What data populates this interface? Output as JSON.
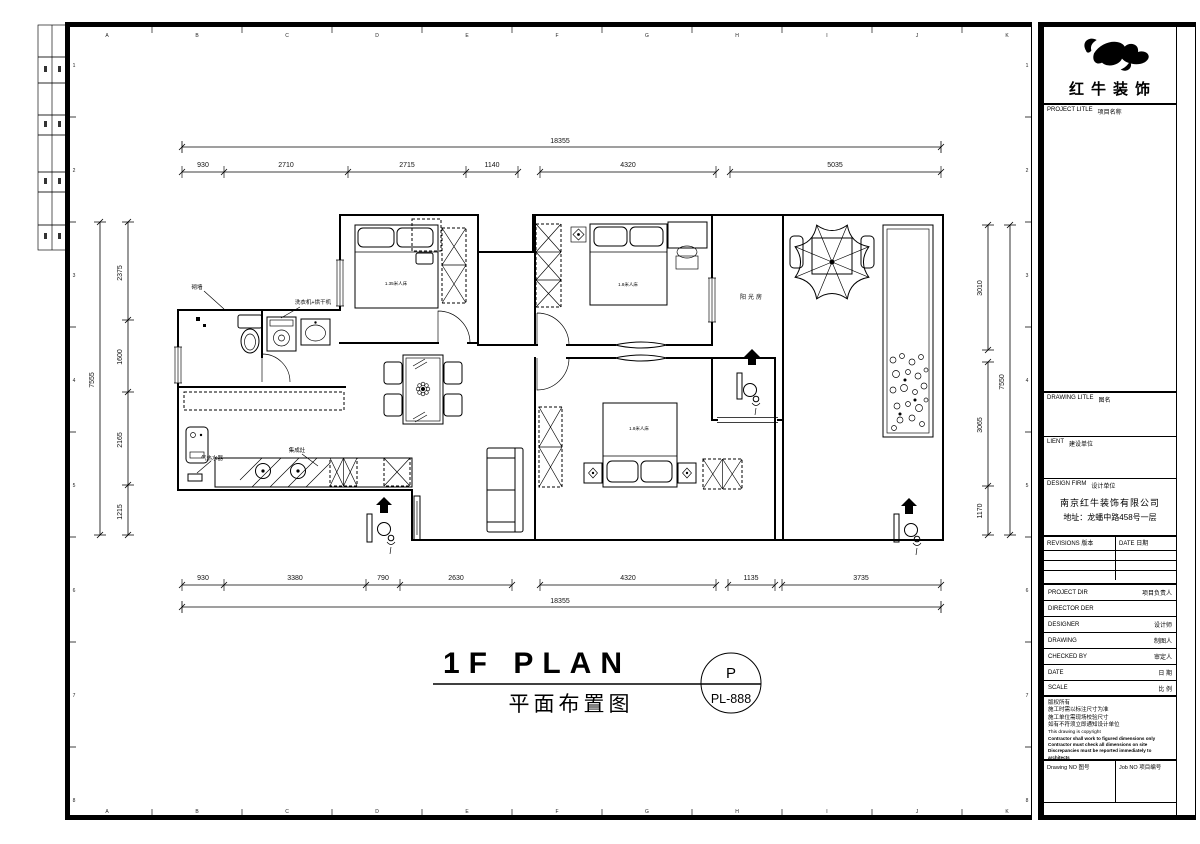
{
  "frame": {
    "letters": [
      "A",
      "B",
      "C",
      "D",
      "E",
      "F",
      "G",
      "H",
      "I",
      "J",
      "K"
    ],
    "numbers": [
      "1",
      "2",
      "3",
      "4",
      "5",
      "6",
      "7",
      "8"
    ]
  },
  "plan": {
    "dims": {
      "top_total": "18355",
      "top": [
        "930",
        "2710",
        "2715",
        "1140",
        "4320",
        "5035"
      ],
      "bottom": [
        "930",
        "3380",
        "790",
        "2630",
        "4320",
        "1135",
        "3735"
      ],
      "bottom_total": "18355",
      "left": [
        "2375",
        "1600",
        "2165",
        "1215"
      ],
      "left_total": "7555",
      "right": [
        "3010",
        "3065",
        "1170"
      ],
      "right_total": "7550"
    },
    "labels": {
      "build_wall": "砌墙",
      "washer_dryer": "洗衣机+烘干机",
      "gas_water_heater": "气热水器",
      "integrated_stove": "集成灶",
      "sunroom": "阳光房",
      "bed_small": "1.35米人床",
      "bed_master": "1.8米人床",
      "bed_second": "1.8米人床"
    },
    "title": {
      "en": "1F PLAN",
      "zh": "平面布置图",
      "sheet_letter": "P",
      "sheet_code": "PL-888"
    }
  },
  "titleblock": {
    "brand": "红牛装饰",
    "project_title": {
      "en": "PROJECT LITLE",
      "zh": "项目名称"
    },
    "drawing_title": {
      "en": "DRAWING LITLE",
      "zh": "图名"
    },
    "client": {
      "en": "LIENT",
      "zh": "建设单位"
    },
    "design_firm": {
      "en": "DESIGN FIRM",
      "zh": "设计单位"
    },
    "firm_name": "南京红牛装饰有限公司",
    "firm_address": "地址：龙蟠中路458号一层",
    "revisions": {
      "en": "REVISIONS",
      "zh": "版本"
    },
    "date_col": {
      "en": "DATE",
      "zh": "日期"
    },
    "rows": [
      {
        "en": "PROJECT DIR",
        "zh": "项目负责人"
      },
      {
        "en": "DIRECTOR DER",
        "zh": ""
      },
      {
        "en": "DESIGNER",
        "zh": "设计师"
      },
      {
        "en": "DRAWING",
        "zh": "制图人"
      },
      {
        "en": "CHECKED BY",
        "zh": "审定人"
      },
      {
        "en": "DATE",
        "zh": "日 期"
      },
      {
        "en": "SCALE",
        "zh": "比 例"
      }
    ],
    "notes_cn": [
      "版权所有",
      "施工时需以标注尺寸为准",
      "施工单位需现场校验尺寸",
      "如有不符须立即通知设计单位"
    ],
    "notes_en": [
      "This drawing is copyright",
      "Contractor shall work to figured dimensions only",
      "Contractor must check all dimensions on site",
      "Discrepancies must be reported immediately to architects"
    ],
    "drawing_no": {
      "en": "Drawing NO",
      "zh": "图号"
    },
    "job_no": {
      "en": "Job NO",
      "zh": "项目编号"
    }
  }
}
